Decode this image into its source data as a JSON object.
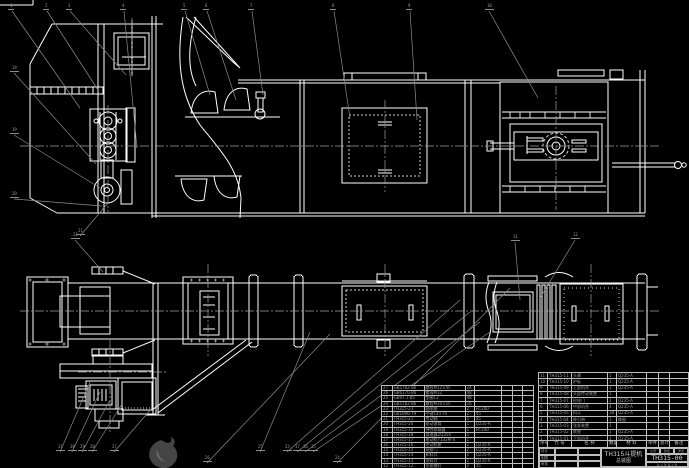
{
  "drawing": {
    "title_line1": "TH315斗提机",
    "title_line2": "总装图",
    "drawing_no": "TH315-00",
    "sheet_note": "共 1 张  第 1 张",
    "accent_line_color": "#ffffff",
    "leader_color": "#8c8c8c",
    "background_color": "#000000"
  },
  "title_block": {
    "sign_rows": [
      "设计",
      "制图",
      "审核",
      "批准"
    ],
    "strip_cells": [
      "比例",
      "数量",
      "重量"
    ]
  },
  "bom": {
    "header": [
      "序号",
      "代  号",
      "名  称",
      "数量",
      "材  料",
      "单件",
      "总计",
      "备注"
    ],
    "left_rows": [
      [
        "27",
        "GB5782-86",
        "螺栓M12×45",
        "24",
        "",
        "",
        "",
        ""
      ],
      [
        "26",
        "GB6170-86",
        "螺母M12",
        "48",
        "",
        "",
        "",
        ""
      ],
      [
        "25",
        "GB97.1-85",
        "垫圈12",
        "48",
        "",
        "",
        "",
        ""
      ],
      [
        "24",
        "GB5782-86",
        "螺栓M16×55",
        "16",
        "",
        "",
        "",
        ""
      ],
      [
        "23",
        "TH315-23",
        "轴承座",
        "2",
        "HT200",
        "",
        "",
        ""
      ],
      [
        "22",
        "GB1096-79",
        "平键14×70",
        "2",
        "45",
        "",
        "",
        ""
      ],
      [
        "21",
        "TH315-21",
        "传动轴",
        "1",
        "45",
        "",
        "",
        ""
      ],
      [
        "20",
        "TH315-20",
        "驱动滚筒",
        "1",
        "Q235-A",
        "",
        "",
        ""
      ],
      [
        "19",
        "TH315-19",
        "弹性联轴器",
        "1",
        "HT200",
        "",
        "",
        ""
      ],
      [
        "18",
        "TH315-18",
        "减速器ZQ350",
        "1",
        "",
        "",
        "",
        ""
      ],
      [
        "17",
        "TH315-17",
        "电动机Y132M-4",
        "1",
        "",
        "",
        "",
        ""
      ],
      [
        "16",
        "TH315-16",
        "传动机座",
        "1",
        "Q235-A",
        "",
        "",
        ""
      ],
      [
        "15",
        "TH315-15",
        "观察门",
        "2",
        "Q235-A",
        "",
        "",
        ""
      ],
      [
        "14",
        "TH315-14",
        "卸料口",
        "1",
        "Q235-A",
        "",
        "",
        ""
      ],
      [
        "13",
        "TH315-13",
        "进料口",
        "1",
        "Q235-A",
        "",
        "",
        ""
      ],
      [
        "12",
        "TH315-12",
        "张紧螺杆",
        "2",
        "35",
        "",
        "",
        ""
      ]
    ],
    "right_rows": [
      [
        "11",
        "TH315-11",
        "头罩",
        "1",
        "Q235-A",
        "",
        "",
        ""
      ],
      [
        "10",
        "TH315-10",
        "护板",
        "1",
        "Q235-A",
        "",
        "",
        ""
      ],
      [
        "9",
        "TH315-09",
        "上部机壳",
        "1",
        "Q235-A",
        "",
        "",
        ""
      ],
      [
        "8",
        "TH315-08",
        "头部传动装置",
        "1",
        "",
        "",
        "",
        ""
      ],
      [
        "7",
        "TH315-07",
        "检修门",
        "2",
        "Q235-A",
        "",
        "",
        ""
      ],
      [
        "6",
        "TH315-06",
        "中部机壳",
        "4",
        "Q235-A",
        "",
        "",
        ""
      ],
      [
        "5",
        "TH315-05",
        "料斗",
        "38",
        "Q235-A",
        "",
        "",
        ""
      ],
      [
        "4",
        "TH315-04",
        "牵引带",
        "1",
        "橡胶",
        "",
        "",
        ""
      ],
      [
        "3",
        "TH315-03",
        "张紧装置",
        "1",
        "",
        "",
        "",
        ""
      ],
      [
        "2",
        "TH315-02",
        "底座",
        "1",
        "Q235-A",
        "",
        "",
        ""
      ],
      [
        "1",
        "TH315-01",
        "下部机壳",
        "1",
        "Q235-A",
        "",
        "",
        ""
      ]
    ]
  },
  "balloons": [
    {
      "n": "1",
      "x": 10,
      "y": 8,
      "lx": 80,
      "ly": 108
    },
    {
      "n": "2",
      "x": 45,
      "y": 8,
      "lx": 98,
      "ly": 90
    },
    {
      "n": "3",
      "x": 68,
      "y": 8,
      "lx": 126,
      "ly": 75
    },
    {
      "n": "4",
      "x": 122,
      "y": 8,
      "lx": 137,
      "ly": 148
    },
    {
      "n": "5",
      "x": 183,
      "y": 8,
      "lx": 210,
      "ly": 95
    },
    {
      "n": "6",
      "x": 205,
      "y": 8,
      "lx": 236,
      "ly": 100
    },
    {
      "n": "7",
      "x": 250,
      "y": 8,
      "lx": 263,
      "ly": 95
    },
    {
      "n": "8",
      "x": 332,
      "y": 8,
      "lx": 350,
      "ly": 118
    },
    {
      "n": "9",
      "x": 408,
      "y": 8,
      "lx": 417,
      "ly": 120
    },
    {
      "n": "10",
      "x": 487,
      "y": 8,
      "lx": 538,
      "ly": 98
    },
    {
      "n": "18",
      "x": 12,
      "y": 70,
      "lx": 96,
      "ly": 164
    },
    {
      "n": "19",
      "x": 12,
      "y": 132,
      "lx": 100,
      "ly": 188
    },
    {
      "n": "20",
      "x": 12,
      "y": 196,
      "lx": 102,
      "ly": 206
    },
    {
      "n": "21",
      "x": 78,
      "y": 233,
      "lx": 108,
      "ly": 203
    },
    {
      "n": "22",
      "x": 73,
      "y": 237,
      "lx": 103,
      "ly": 272
    },
    {
      "n": "11",
      "x": 513,
      "y": 239,
      "lx": 520,
      "ly": 300
    },
    {
      "n": "12",
      "x": 573,
      "y": 237,
      "lx": 540,
      "ly": 298
    },
    {
      "n": "31",
      "x": 58,
      "y": 449,
      "lx": 90,
      "ly": 382
    },
    {
      "n": "30",
      "x": 70,
      "y": 449,
      "lx": 100,
      "ly": 392
    },
    {
      "n": "29",
      "x": 80,
      "y": 449,
      "lx": 110,
      "ly": 400
    },
    {
      "n": "28",
      "x": 90,
      "y": 449,
      "lx": 122,
      "ly": 404
    },
    {
      "n": "27",
      "x": 112,
      "y": 449,
      "lx": 152,
      "ly": 408
    },
    {
      "n": "26",
      "x": 205,
      "y": 460,
      "lx": 330,
      "ly": 334
    },
    {
      "n": "25",
      "x": 258,
      "y": 449,
      "lx": 310,
      "ly": 332
    },
    {
      "n": "24",
      "x": 335,
      "y": 460,
      "lx": 510,
      "ly": 288
    },
    {
      "n": "23",
      "x": 285,
      "y": 449,
      "lx": 460,
      "ly": 300
    },
    {
      "n": "17",
      "x": 295,
      "y": 449,
      "lx": 470,
      "ly": 312
    },
    {
      "n": "16",
      "x": 303,
      "y": 449,
      "lx": 480,
      "ly": 322
    },
    {
      "n": "15",
      "x": 311,
      "y": 449,
      "lx": 490,
      "ly": 332
    }
  ]
}
